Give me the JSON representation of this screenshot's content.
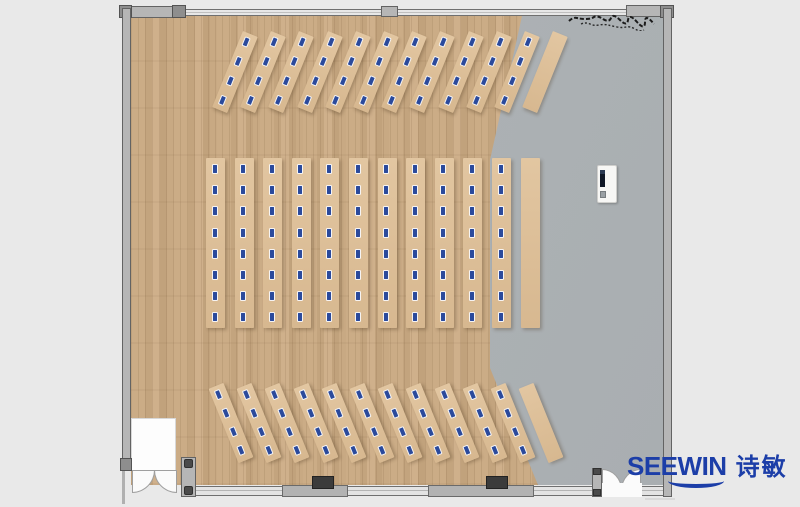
{
  "meta": {
    "description": "Top-view floor plan rendering of a training / computer classroom"
  },
  "logo": {
    "brand_latin": "SEEWIN",
    "brand_cjk": "诗敏",
    "color": "#1c3ea8"
  },
  "palette": {
    "outside": "#e9e9e9",
    "wood_floor": "#c7a882",
    "gray_floor": "#adb2b4",
    "desk": "#ddc09a",
    "monitor_blue": "#2b4a9c",
    "wall_fill": "#b6b6b6",
    "wall_line": "#636363",
    "block_dark": "#3b3b3b",
    "podium_white": "#f7f7f5",
    "logo_blue": "#1c3ea8"
  },
  "floorplan": {
    "sections": [
      {
        "id": "front-angled-row",
        "angle_deg": 22,
        "x": 227,
        "y": 31,
        "spacing": 28.2,
        "strip_w": 16,
        "strip_h": 82,
        "count": 12,
        "monitors": 4,
        "monitor_start": 5,
        "monitor_gap": 21,
        "last_empty": true
      },
      {
        "id": "center-columns",
        "angle_deg": 0,
        "x": 206,
        "y": 158,
        "spacing": 28.6,
        "strip_w": 19,
        "strip_h": 170,
        "count": 12,
        "monitors": 8,
        "monitor_start": 7,
        "monitor_gap": 21.2,
        "last_empty": true
      },
      {
        "id": "rear-angled-row",
        "angle_deg": -22,
        "x": 223,
        "y": 383,
        "spacing": 28.2,
        "strip_w": 16,
        "strip_h": 80,
        "count": 12,
        "monitors": 4,
        "monitor_start": 5,
        "monitor_gap": 20,
        "last_empty": true
      }
    ],
    "podium": {
      "x": 597,
      "y": 165
    },
    "doors": [
      {
        "id": "entry-vestibule-double-door",
        "side": "bottom-left"
      },
      {
        "id": "double-door-right",
        "side": "bottom-right"
      }
    ]
  }
}
